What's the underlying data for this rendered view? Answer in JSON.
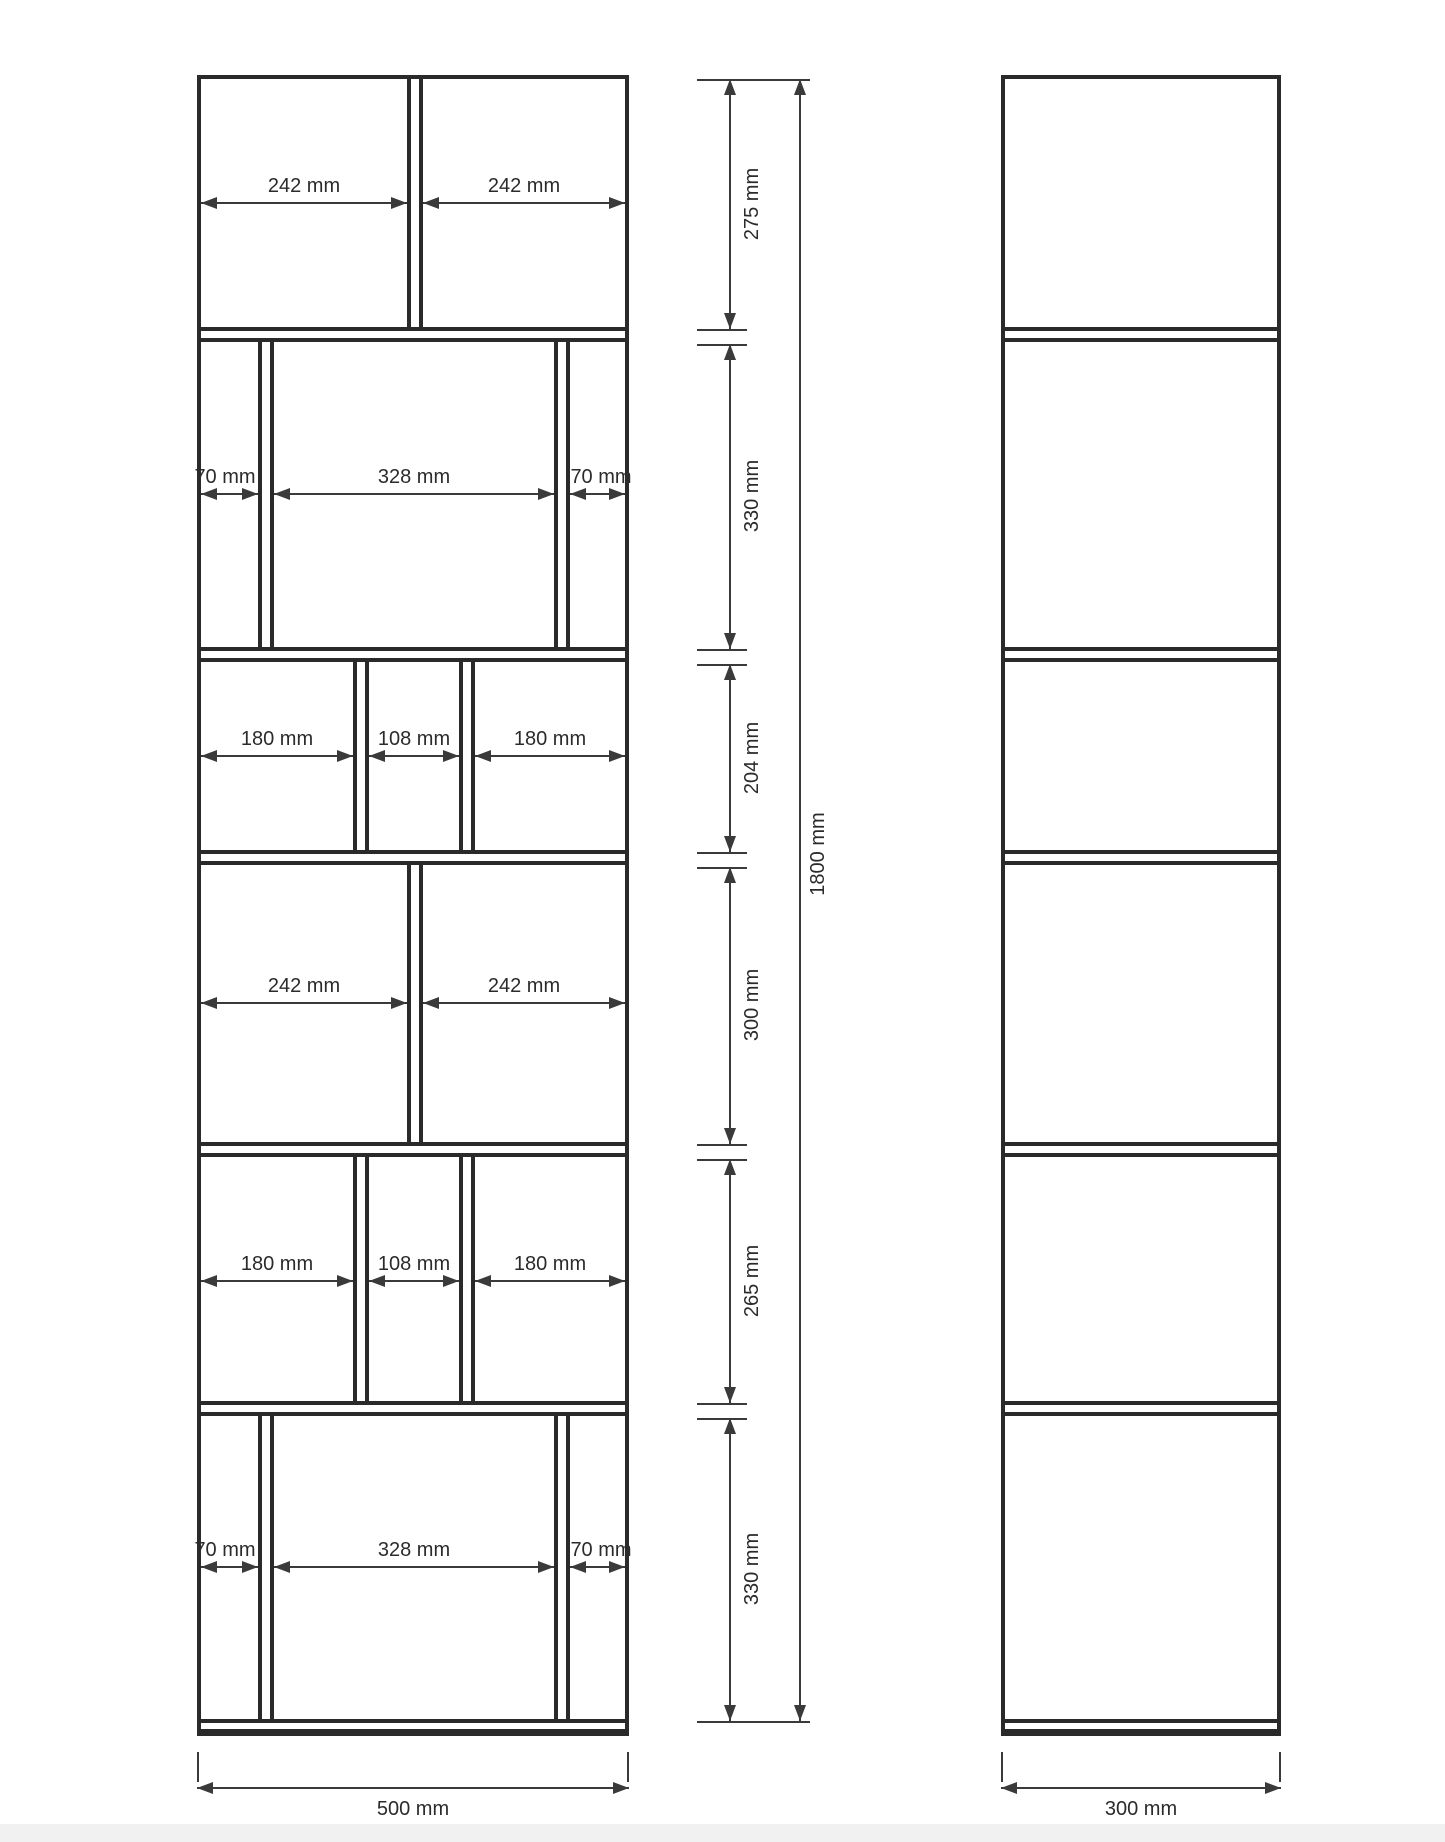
{
  "front_view": {
    "width_label": "500 mm",
    "total_height_label": "1800 mm",
    "rows": [
      {
        "height": "275 mm",
        "widths": [
          "242 mm",
          "242 mm"
        ]
      },
      {
        "height": "330 mm",
        "widths": [
          "70 mm",
          "328 mm",
          "70 mm"
        ]
      },
      {
        "height": "204 mm",
        "widths": [
          "180 mm",
          "108 mm",
          "180 mm"
        ]
      },
      {
        "height": "300 mm",
        "widths": [
          "242 mm",
          "242 mm"
        ]
      },
      {
        "height": "265 mm",
        "widths": [
          "180 mm",
          "108 mm",
          "180 mm"
        ]
      },
      {
        "height": "330 mm",
        "widths": [
          "70 mm",
          "328 mm",
          "70 mm"
        ]
      }
    ]
  },
  "side_view": {
    "width_label": "300 mm"
  }
}
